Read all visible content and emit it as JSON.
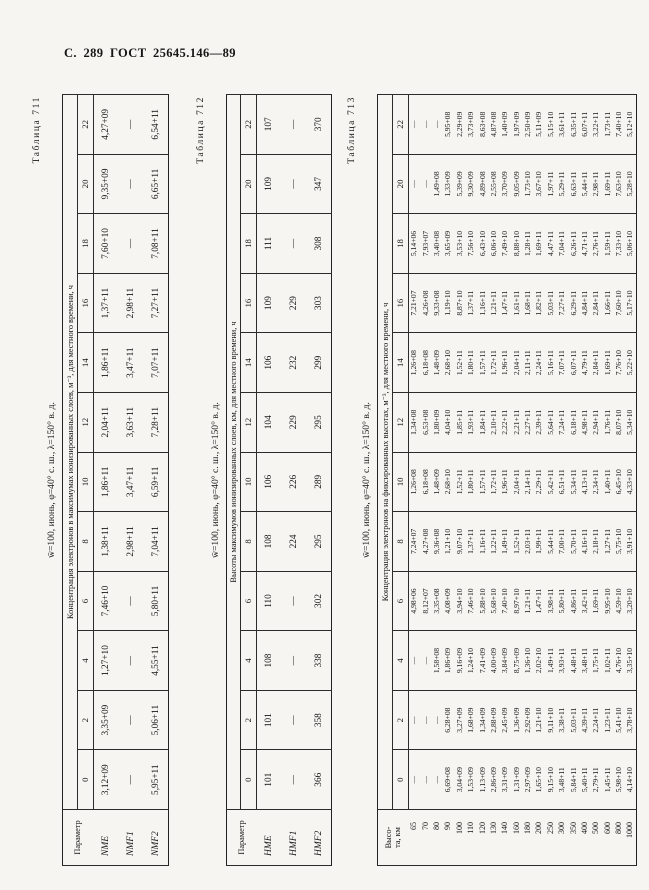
{
  "page": {
    "header": "С. 289 ГОСТ 25645.146—89"
  },
  "tables": [
    {
      "caption": "Таблица 711",
      "title": "w̄=100, июнь, φ=40° с. ш., λ=150° в. д.",
      "stub_header": "Параметр",
      "span_header": "Концентрация электронов в максимумах ионизированных слоев, м⁻³, для местного времени, ч",
      "time_cols": [
        "0",
        "2",
        "4",
        "6",
        "8",
        "10",
        "12",
        "14",
        "16",
        "18",
        "20",
        "22"
      ],
      "rows": [
        {
          "label": "NME",
          "values": [
            "3,12+09",
            "3,35+09",
            "1,27+10",
            "7,46+10",
            "1,38+11",
            "1,86+11",
            "2,04+11",
            "1,86+11",
            "1,37+11",
            "7,60+10",
            "9,35+09",
            "4,27+09"
          ]
        },
        {
          "label": "NMF1",
          "values": [
            "—",
            "—",
            "—",
            "—",
            "2,98+11",
            "3,47+11",
            "3,63+11",
            "3,47+11",
            "2,98+11",
            "—",
            "—",
            "—"
          ]
        },
        {
          "label": "NMF2",
          "values": [
            "5,95+11",
            "5,06+11",
            "4,55+11",
            "5,80+11",
            "7,04+11",
            "6,59+11",
            "7,28+11",
            "7,07+11",
            "7,27+11",
            "7,08+11",
            "6,65+11",
            "6,54+11"
          ]
        }
      ]
    },
    {
      "caption": "Таблица 712",
      "title": "w̄=100, июнь, φ=40° с. ш., λ=150° в. д.",
      "stub_header": "Параметр",
      "span_header": "Высоты максимумов ионизированных слоев, км, для местного времени, ч",
      "time_cols": [
        "0",
        "2",
        "4",
        "6",
        "8",
        "10",
        "12",
        "14",
        "16",
        "18",
        "20",
        "22"
      ],
      "rows": [
        {
          "label": "HME",
          "values": [
            "101",
            "101",
            "108",
            "110",
            "108",
            "106",
            "104",
            "106",
            "109",
            "111",
            "109",
            "107"
          ]
        },
        {
          "label": "HMF1",
          "values": [
            "—",
            "—",
            "—",
            "—",
            "224",
            "226",
            "229",
            "232",
            "229",
            "—",
            "—",
            "—"
          ]
        },
        {
          "label": "HMF2",
          "values": [
            "366",
            "358",
            "338",
            "302",
            "295",
            "289",
            "295",
            "299",
            "303",
            "308",
            "347",
            "370"
          ]
        }
      ]
    },
    {
      "caption": "Таблица 713",
      "title": "w̄=100, июнь, φ=40° с. ш., λ=150° в. д.",
      "stub_header": "Высо-\nта, км",
      "span_header": "Концентрация электронов на фиксированных высотах, м⁻³, для местного времени, ч",
      "time_cols": [
        "0",
        "2",
        "4",
        "6",
        "8",
        "10",
        "12",
        "14",
        "16",
        "18",
        "20",
        "22"
      ],
      "rows": [
        {
          "label": "65",
          "values": [
            "—",
            "—",
            "—",
            "4,98+06",
            "7,24+07",
            "1,26+08",
            "1,34+08",
            "1,26+08",
            "7,21+07",
            "5,14+06",
            "—",
            "—"
          ]
        },
        {
          "label": "70",
          "values": [
            "—",
            "—",
            "—",
            "8,12+07",
            "4,27+08",
            "6,18+08",
            "6,53+08",
            "6,18+08",
            "4,26+08",
            "7,93+07",
            "—",
            "—"
          ]
        },
        {
          "label": "80",
          "values": [
            "—",
            "—",
            "1,58+08",
            "3,35+08",
            "9,36+08",
            "1,48+09",
            "1,80+09",
            "1,48+09",
            "9,33+08",
            "3,40+08",
            "1,49+08",
            "—"
          ]
        },
        {
          "label": "90",
          "values": [
            "6,69+08",
            "6,28+08",
            "1,86+09",
            "4,08+09",
            "1,21+10",
            "2,68+10",
            "4,04+10",
            "2,68+10",
            "1,19+10",
            "3,65+09",
            "1,33+09",
            "5,95+08"
          ]
        },
        {
          "label": "100",
          "values": [
            "3,04+09",
            "3,27+09",
            "9,16+09",
            "3,94+10",
            "9,07+10",
            "1,52+11",
            "1,85+11",
            "1,52+11",
            "8,87+10",
            "3,53+10",
            "5,39+09",
            "2,29+09"
          ]
        },
        {
          "label": "110",
          "values": [
            "1,53+09",
            "1,68+09",
            "1,24+10",
            "7,46+10",
            "1,37+11",
            "1,80+11",
            "1,93+11",
            "1,80+11",
            "1,37+11",
            "7,56+10",
            "9,30+09",
            "3,73+09"
          ]
        },
        {
          "label": "120",
          "values": [
            "1,13+09",
            "1,34+09",
            "7,41+09",
            "5,88+10",
            "1,16+11",
            "1,57+11",
            "1,84+11",
            "1,57+11",
            "1,16+11",
            "6,43+10",
            "4,89+08",
            "8,63+08"
          ]
        },
        {
          "label": "130",
          "values": [
            "2,86+09",
            "2,88+09",
            "4,00+09",
            "5,68+10",
            "1,22+11",
            "1,72+11",
            "2,10+11",
            "1,72+11",
            "1,21+11",
            "6,06+10",
            "2,55+08",
            "4,87+08"
          ]
        },
        {
          "label": "140",
          "values": [
            "3,31+09",
            "2,45+09",
            "3,84+09",
            "7,40+10",
            "1,49+11",
            "1,96+11",
            "2,22+11",
            "1,96+11",
            "1,47+11",
            "7,49+10",
            "3,70+09",
            "1,40+09"
          ]
        },
        {
          "label": "160",
          "values": [
            "1,31+09",
            "1,36+09",
            "8,75+09",
            "8,97+10",
            "1,52+11",
            "2,04+11",
            "2,21+11",
            "2,04+11",
            "1,61+11",
            "8,88+10",
            "9,05+09",
            "1,97+09"
          ]
        },
        {
          "label": "180",
          "values": [
            "2,97+09",
            "2,92+09",
            "1,36+10",
            "1,21+11",
            "2,03+11",
            "2,14+11",
            "2,27+11",
            "2,11+11",
            "1,68+11",
            "1,28+11",
            "1,73+10",
            "2,50+09"
          ]
        },
        {
          "label": "200",
          "values": [
            "1,65+10",
            "1,21+10",
            "2,02+10",
            "1,47+11",
            "1,99+11",
            "2,29+11",
            "2,39+11",
            "2,24+11",
            "1,82+11",
            "1,69+11",
            "3,67+10",
            "5,11+09"
          ]
        },
        {
          "label": "250",
          "values": [
            "9,15+10",
            "9,11+10",
            "1,49+11",
            "3,98+11",
            "5,44+11",
            "5,42+11",
            "5,64+11",
            "5,16+11",
            "5,03+11",
            "4,47+11",
            "1,97+11",
            "5,15+10"
          ]
        },
        {
          "label": "300",
          "values": [
            "3,48+11",
            "3,38+11",
            "3,93+11",
            "5,80+11",
            "7,00+11",
            "6,51+11",
            "7,24+11",
            "7,07+11",
            "7,27+11",
            "7,04+11",
            "5,29+11",
            "3,61+11"
          ]
        },
        {
          "label": "350",
          "values": [
            "5,84+11",
            "5,03+11",
            "4,48+11",
            "4,86+11",
            "5,70+11",
            "5,34+11",
            "6,18+11",
            "6,07+11",
            "6,29+11",
            "6,26+11",
            "6,63+11",
            "6,35+11"
          ]
        },
        {
          "label": "400",
          "values": [
            "5,40+11",
            "4,39+11",
            "3,48+11",
            "3,42+11",
            "4,16+11",
            "4,13+11",
            "4,98+11",
            "4,79+11",
            "4,84+11",
            "4,71+11",
            "5,44+11",
            "6,07+11"
          ]
        },
        {
          "label": "500",
          "values": [
            "2,79+11",
            "2,24+11",
            "1,75+11",
            "1,69+11",
            "2,18+11",
            "2,34+11",
            "2,94+11",
            "2,84+11",
            "2,84+11",
            "2,76+11",
            "2,98+11",
            "3,22+11"
          ]
        },
        {
          "label": "600",
          "values": [
            "1,45+11",
            "1,23+11",
            "1,02+11",
            "9,95+10",
            "1,27+11",
            "1,40+11",
            "1,76+11",
            "1,69+11",
            "1,66+11",
            "1,59+11",
            "1,69+11",
            "1,73+11"
          ]
        },
        {
          "label": "800",
          "values": [
            "5,98+10",
            "5,41+10",
            "4,76+10",
            "4,59+10",
            "5,75+10",
            "6,45+10",
            "8,07+10",
            "7,76+10",
            "7,60+10",
            "7,33+10",
            "7,63+10",
            "7,40+10"
          ]
        },
        {
          "label": "1000",
          "values": [
            "4,14+10",
            "3,78+10",
            "3,35+10",
            "3,20+10",
            "3,91+10",
            "4,33+10",
            "5,34+10",
            "5,22+10",
            "5,17+10",
            "5,06+10",
            "5,28+10",
            "5,12+10"
          ]
        }
      ]
    }
  ]
}
